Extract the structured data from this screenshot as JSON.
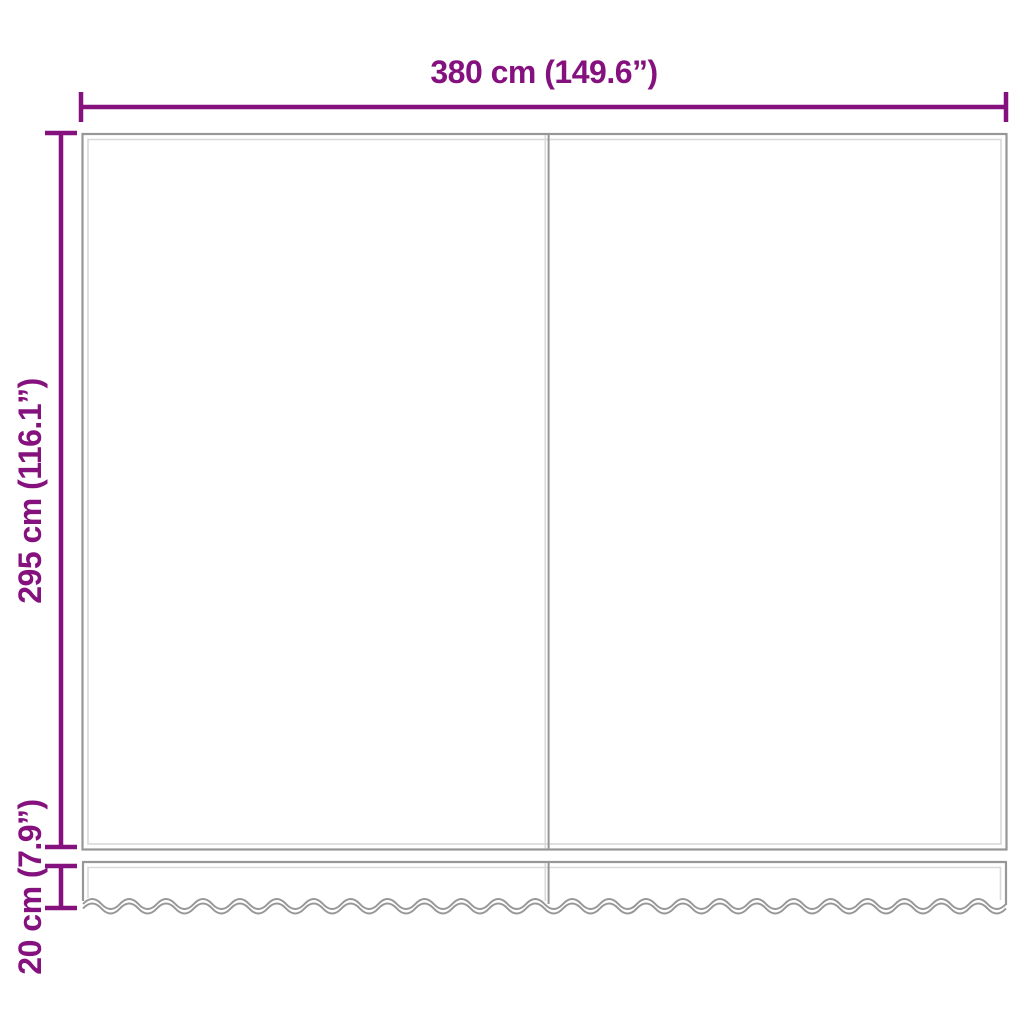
{
  "diagram": {
    "title": "awning-replacement-fabric-dimensions",
    "labels": {
      "width": "380 cm (149.6”)",
      "height": "295 cm (116.1”)",
      "valance_height": "20 cm (7.9”)"
    },
    "measurements": {
      "width_cm": 380,
      "width_in": 149.6,
      "height_cm": 295,
      "height_in": 116.1,
      "valance_height_cm": 20,
      "valance_height_in": 7.9
    },
    "colors": {
      "dimension": "#85117e",
      "outline": "#979797",
      "outline-light": "#d9d9d9",
      "background": "#ffffff"
    }
  }
}
